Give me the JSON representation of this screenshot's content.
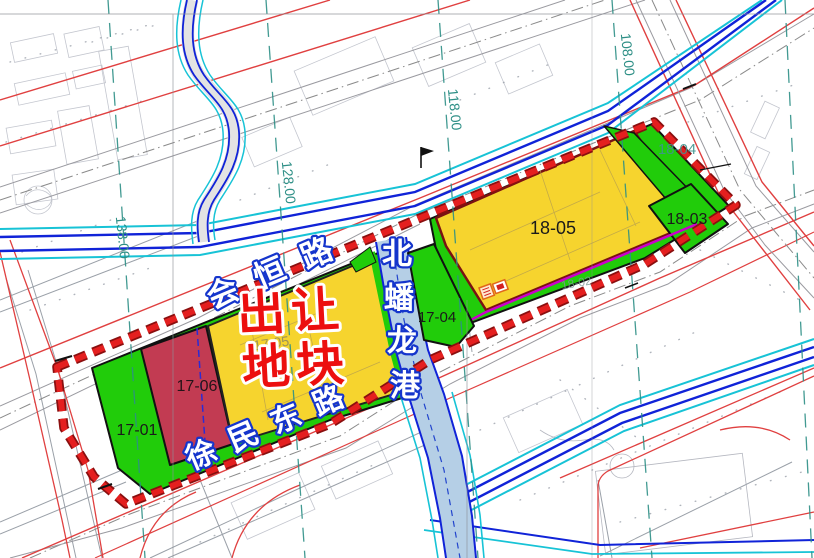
{
  "map": {
    "highlight_label": {
      "line1": "出让",
      "line2": "地块"
    },
    "roads": {
      "huiheng": "会恒路",
      "xumindong": "徐民东路"
    },
    "river": {
      "chars": [
        "北",
        "蟠",
        "龙",
        "港"
      ]
    },
    "parcels": {
      "p17_01": "17-01",
      "p17_04": "17-04",
      "p17_05": "17-05",
      "p17_06": "17-06",
      "p18_02": "18-02",
      "p18_03": "18-03",
      "p18_04": "18-04",
      "p18_05": "18-05"
    },
    "survey_lines": [
      "138.00",
      "128.00",
      "118.00",
      "108.00"
    ],
    "colors": {
      "parcel_yellow": "#f6d42e",
      "parcel_green": "#21cc0a",
      "parcel_red": "#c23b52",
      "river_fill": "#b5cfe6",
      "boundary_red": "#e41f1f",
      "road_line_red": "#e04040",
      "canal_blue": "#1023d8",
      "canal_cyan": "#17c3d6",
      "survey_teal": "#2e8f86",
      "label_outline_blue": "#1535cc",
      "highlight_text_red": "#ec0f0f",
      "magenta_line": "#cc00cc"
    }
  }
}
